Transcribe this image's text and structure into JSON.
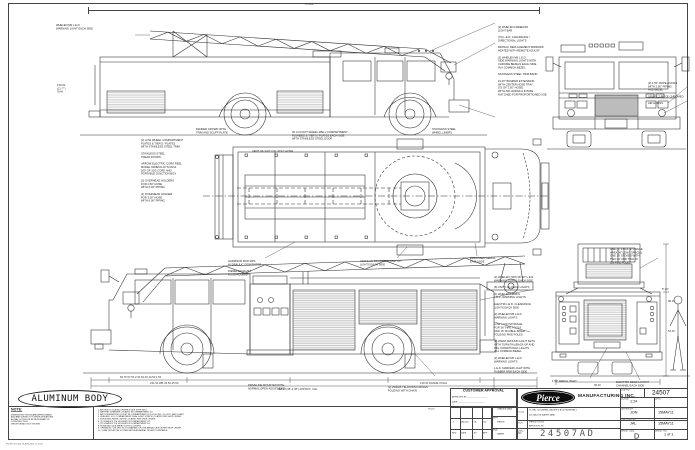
{
  "sheet": {
    "plot_note": "Plot File Created  29-AUG-2011  11:15:28",
    "aluminum_body": "ALUMINUM BODY",
    "note_title": "NOTE:",
    "note_body": [
      "DIMENSIONS SHOWN ARE APPROXIMATE",
      "AND ARE SUBJECT TO MINOR DEVIATIONS",
      "AS MAY OCCUR OR BE NECESSARY IN",
      "CONSTRUCTION.",
      "MINOR DETAILS NOT SHOWN."
    ],
    "numbered_notes": [
      "1.  AIR INLET LOCATED DRIVER'S SIDE STEP WELL.",
      "2.  BATTERY CHARGER LOCATED IN COMPARTMENT D4.",
      "3.  AIR COMPRESSOR OUTLET IN COMPARTMENTS D1 & D4 FWD, 115 VOLT, AND D4 AFT.",
      "4.  WHELEN L.E.D. COMPARTMENT DUAL LIGHT STRIPS LOCATED PER SHOP ORDER.",
      "5.  MOUNTING RISER LIGHTS LOCATED PER SHOP ORDER.",
      "6.  (2) SCBA BOTTLE HOLDERS IN COMPARTMENT D2.",
      "7.  (2) SCBA BOTTLE HOLDERS IN COMPARTMENT D3.",
      "8.  HOSE BED SIDE SHEETS WITH LOUVERS.",
      "9.  OPENINGS / CHLORO SLOTS MARKED ON THE AERIAL DEVICE PER SHOP ORDER.",
      "10. 2-WAY INTERCOM SYSTEM BETWEEN AERIAL TIP AND TURNTABLE."
    ],
    "notes_ref": "TK-116"
  },
  "approval": {
    "title": "CUSTOMER APPROVAL",
    "approved_by": "APPROVED BY: _________________",
    "date": "DATE: _______________________"
  },
  "rev_table": {
    "entry": [
      "1",
      "2AUG11",
      "JA",
      "116"
    ],
    "headers": [
      "REV",
      "DATE",
      "BY",
      "APP"
    ]
  },
  "chassis": {
    "header": "CHASSIS DATA",
    "mfr_label": "MFR",
    "mfr": "PIERCE",
    "mdl_label": "MDL",
    "mdl": "SABER"
  },
  "titleblock": {
    "brand": "Pierce",
    "mfg": "MANUFACTURING INC.",
    "job_label": "JOB NO.",
    "job": "24507",
    "scale_label": "SCALE",
    "scale": "1:24",
    "date_label": "DATE",
    "title_label": "TITLE",
    "title1": "75' HAL TCO AERIAL LADDER & BODY ASSEMBLY",
    "title2": "500 GALLON WATER TANK",
    "for_label": "FOR",
    "for1": "PIERCE STOCK",
    "for2": "APPLETON, WI",
    "drawn_label": "DRAWN BY",
    "drawn": "JON",
    "drawn_date": "15MAY11",
    "checked_label": "CHECKED BY",
    "checked": "JAL",
    "checked_date": "15MAY11",
    "size_label": "SHEET SIZE",
    "size": "D",
    "sheetno_label": "SHEET NO.",
    "sheetno": "1 of 1",
    "dwg_label": "DWG\nNO.",
    "dwg": "24507AD"
  },
  "callouts": {
    "v1_left": [
      "WHELEN M9 L.E.D.",
      "WARNING LIGHT EACH SIDE"
    ],
    "v1_right": [
      "(2) WHELEN FREEDOM",
      "LIGHT BAR",
      "",
      "(70) L.E.D. CLEARANCE /",
      "DIRECTIONAL LIGHTS",
      "",
      "RETRAC REPLACEMENT MIRRORS",
      "HEATED WITH REMOTE ADJUST",
      "",
      "(2) WHELEN M6 L.E.D.",
      "SIDE WARNING LIGHTS WITH",
      "CHROME BEZELS EACH SIDE",
      "IN A COMMON BEZEL",
      "",
      "STAINLESS STEEL TRIM BAND",
      "",
      "19.00\" BUMPER EXTENSION",
      "WITH CENTER HOSE TRAY",
      "(75' OF 2.50\" HOSE)",
      "WITH AIR HORNS & INTAKE",
      "NOTCHED FOR PROPORTIONED USE"
    ],
    "v1_b1": [
      "FENDER CROWN WITH",
      "TRIM AND SCUFF PLATE"
    ],
    "v1_b2": [
      "30 CU FOOT WHEEL WELL COMPARTMENT",
      "PLUMBED & TIER'S / PLATES EACH SIDE",
      "WITH STAINLESS STEEL DOOR"
    ],
    "v1_b3": [
      "STAINLESS STEEL",
      "WHEEL LINERS"
    ],
    "front_right": [
      "(2) 1.50\" ROPE HOOKS",
      "WITH 2.50\" PIPING",
      "AND BEZEL",
      "",
      "GRILLE 2-PIECE CHROMED",
      "",
      "AIR HORNS"
    ],
    "plan_vent": "VENT OF 3.00\" O.D. POLY HOSE",
    "plan_b1": [
      "HARRISON 6KW MPS",
      "HYDRAULIC GENERATOR",
      "",
      "DIESEL EXHAUST",
      "FLUID ACCESS"
    ],
    "plan_b2": [
      "UNIT'S AS TRUCK/ENG AND TOY",
      "LIGHTS EACH SIDE"
    ],
    "plan_b3": [
      "EMBOSSED AERIAL",
      "EACH SIDE"
    ],
    "mid_left": [
      "(2) LOW WHEEL COMPARTMENT",
      "PLATES & TIER'S / PLATES",
      "WITH STAINLESS STEEL TRIM",
      "",
      "STAINLESS STEEL",
      "TREAD DOORS",
      "",
      "ARROW ELECTRIC CORD REEL",
      "MODEL 600B/CD-DYN 06/12",
      "200' OF 10/3 CORD AND",
      "PORTABLE JUNCTION BOX",
      "",
      "(2) OVERHEAD HOLDERS",
      "FOR 2.50\" HOSE",
      "WITH 6.00\" PIPING",
      "",
      "(1) OVERHEAD HOLDER",
      "FOR 3.00\" HOSE",
      "WITH 6.00\" PIPING"
    ],
    "v4_right": [
      "(2) WHELEN 700S 3D 90° L.E.D.",
      "WARNING LIGHTS EACH SIDE",
      "",
      "(8) UNITY AG DECK LIGHTS",
      "",
      "(4) WHELEN L200FS",
      "L.E.D. WARNING LIGHTS",
      "",
      "ELECTRI L.E.D. CLEARANCE",
      "LIGHTS EACH SIDE",
      "",
      "(2) WHELEN M6 L.E.D.",
      "WARNING LIGHTS",
      "",
      "LOW / CON STORAGE",
      "FOR 36\" FIRE TOOLS",
      "AND 16' DOUBLE-SIDED",
      "FOLDING PIKE POLES",
      "",
      "(2) WRAP AROUND LIGHT SETS",
      "WITH TURN/TAIL/BACK-UP AND",
      "WIG CONDITIONAL LIGHTS",
      "IN A COMMON BEZEL",
      "",
      "(2) WHELEN M6 L.E.D.",
      "WARNING LIGHTS",
      "",
      "L.E.D. MARKER LIGHT WITH",
      "RUBBER ARM EACH SIDE"
    ],
    "v4_b1": [
      "DRIVELINE MOUNTED WITH",
      "NORMAL OPEN ASSIST-EXIT"
    ],
    "v4_b2": [
      "(2) 2500LB TIE-DOWN D-RINGS",
      "FOLDING WITH CHAIN"
    ],
    "rear_r": [
      "ONE (1) STICK STORAGE",
      "AREA 36\" LONG SPECIAL",
      "ONE 16' STOKES WITH",
      "TWO 10' AND TWO 16'",
      "OR PIKE POLES"
    ],
    "rear_b1": [
      "1.50\" AERIAL INLET"
    ],
    "rear_b2": [
      "ELECTRIC DEAD LAYOUT",
      "CHANNEL EACH SIDE"
    ],
    "figure_height": "5'-10\""
  },
  "dims": {
    "top_oal": "575.88",
    "oah": "139.00\n(11'-7\")\nOAH",
    "chain1": "84.75              57.50          2.00        62.00          44.50      1.50",
    "chain2": "231.50 WB                      34.50        45.50",
    "frame": "130.50 FRAME OVHG",
    "oal": "458.38  (38'-2.38\")  APPROX.  OAL",
    "rear_h1": "98.25",
    "rear_h2": "52.25",
    "rear_w": "96.00"
  }
}
